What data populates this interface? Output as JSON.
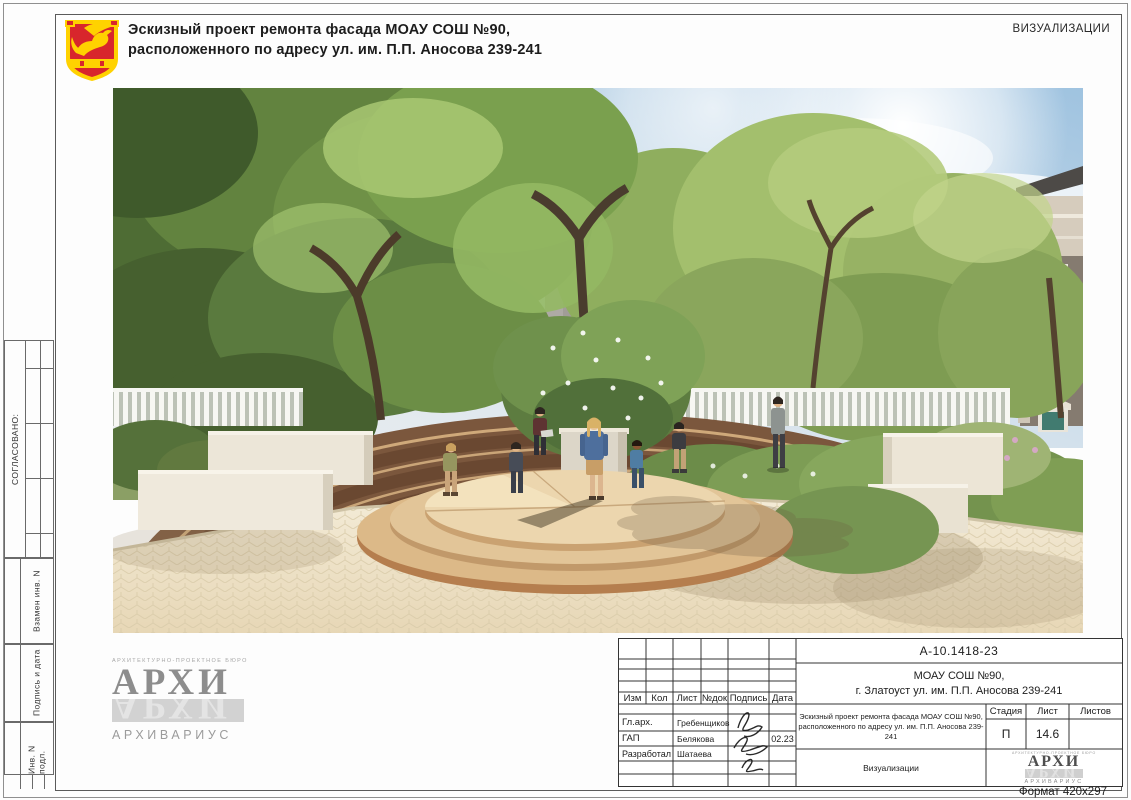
{
  "sheet": {
    "header": {
      "title_line1": "Эскизный проект ремонта фасада МОАУ СОШ №90,",
      "title_line2": "расположенного по адресу ул. им. П.П. Аносова 239-241",
      "corner_label": "ВИЗУАЛИЗАЦИИ"
    },
    "side_stamps": {
      "agreed": "СОГЛАСОВАНО:",
      "replace_inv": "Взамен инв. N",
      "sign_date": "Подпись и дата",
      "inv_no": "Инв. N подл."
    },
    "title_block": {
      "doc_number": "А-10.1418-23",
      "object_line1": "МОАУ СОШ №90,",
      "object_line2": "г. Златоуст ул. им. П.П. Аносова 239-241",
      "columns": {
        "izm": "Изм",
        "kol": "Кол",
        "list": "Лист",
        "ndoc": "№док",
        "sign": "Подпись",
        "date": "Дата"
      },
      "rows": [
        {
          "role": "Гл.арх.",
          "name": "Гребенщиков",
          "date": ""
        },
        {
          "role": "ГАП",
          "name": "Белякова",
          "date": "02.23"
        },
        {
          "role": "Разработал",
          "name": "Шатаева",
          "date": ""
        }
      ],
      "project_line1": "Эскизный проект ремонта фасада МОАУ СОШ №90,",
      "project_line2": "расположенного по адресу ул. им. П.П. Аносова 239-241",
      "stage_label": "Стадия",
      "sheet_label": "Лист",
      "sheets_label": "Листов",
      "stage_value": "П",
      "sheet_value": "14.6",
      "sheets_value": "",
      "section_name": "Визуализации",
      "format_note": "Формат 420x297"
    },
    "logo": {
      "bureau_tagline": "АРХИТЕКТУРНО-ПРОЕКТНОЕ БЮРО",
      "brand": "АРХИ",
      "brand_full": "АРХИВАРИУС"
    },
    "emblem_colors": {
      "shield_red": "#d8262c",
      "gold": "#ffd200"
    }
  }
}
